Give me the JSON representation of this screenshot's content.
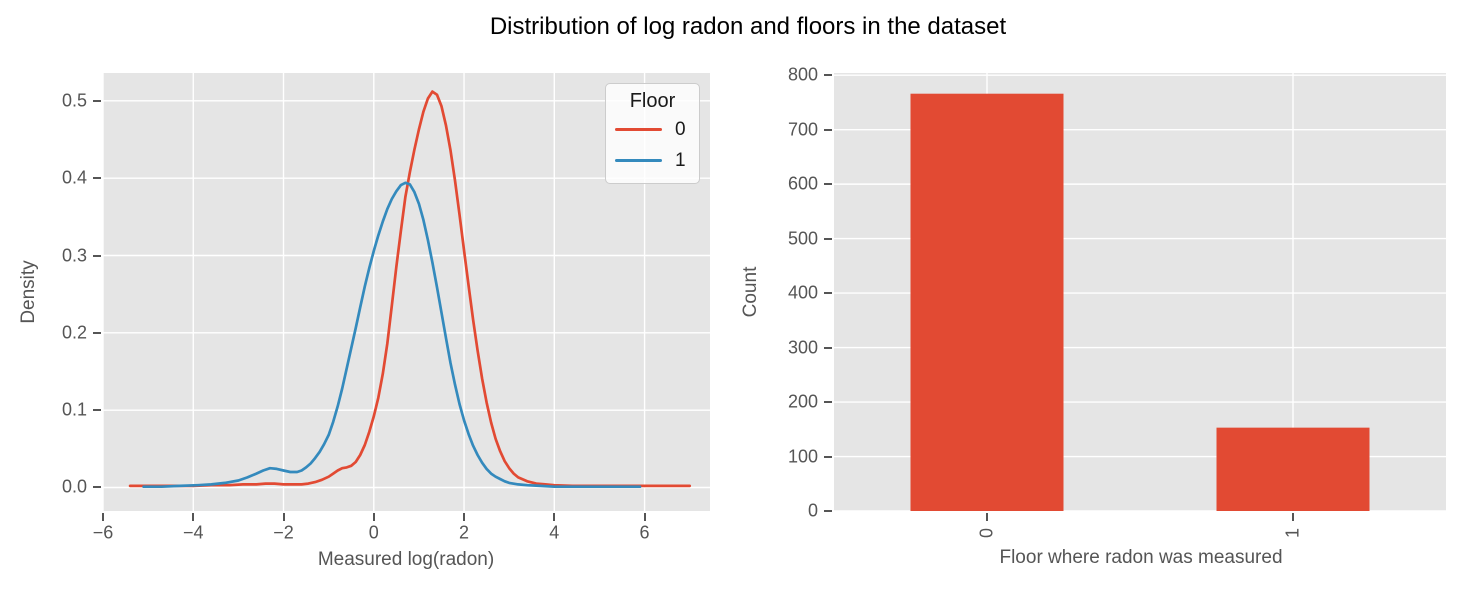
{
  "title": "Distribution of log radon and floors in the dataset",
  "colors": {
    "floor0_red": "#E24A33",
    "floor1_blue": "#348ABD",
    "axes_background": "#E5E5E5",
    "grid": "#FFFFFF",
    "tick_text": "#555555",
    "title_text": "#000000"
  },
  "chart_data": [
    {
      "type": "line",
      "subtype": "kde-density",
      "xlabel": "Measured log(radon)",
      "ylabel": "Density",
      "xlim": [
        -6.0,
        7.45
      ],
      "ylim": [
        -0.0304,
        0.536
      ],
      "grid": true,
      "xticks": [
        -6,
        -4,
        -2,
        0,
        2,
        4,
        6
      ],
      "xtick_labels": [
        "−6",
        "−4",
        "−2",
        "0",
        "2",
        "4",
        "6"
      ],
      "yticks": [
        0,
        0.1,
        0.2,
        0.3,
        0.4,
        0.5
      ],
      "ytick_labels": [
        "0.0",
        "0.1",
        "0.2",
        "0.3",
        "0.4",
        "0.5"
      ],
      "legend": {
        "title": "Floor",
        "position": "upper right",
        "entries": [
          {
            "label": "0",
            "color": "#E24A33"
          },
          {
            "label": "1",
            "color": "#348ABD"
          }
        ]
      },
      "series": [
        {
          "name": "0",
          "color": "#E24A33",
          "points": [
            [
              -5.4,
              0.002
            ],
            [
              -5.0,
              0.002
            ],
            [
              -4.5,
              0.002
            ],
            [
              -4.0,
              0.002
            ],
            [
              -3.6,
              0.003
            ],
            [
              -3.2,
              0.003
            ],
            [
              -2.9,
              0.004
            ],
            [
              -2.6,
              0.004
            ],
            [
              -2.4,
              0.005
            ],
            [
              -2.2,
              0.005
            ],
            [
              -2.0,
              0.004
            ],
            [
              -1.8,
              0.004
            ],
            [
              -1.6,
              0.004
            ],
            [
              -1.45,
              0.005
            ],
            [
              -1.3,
              0.007
            ],
            [
              -1.15,
              0.01
            ],
            [
              -1.0,
              0.014
            ],
            [
              -0.9,
              0.018
            ],
            [
              -0.8,
              0.022
            ],
            [
              -0.7,
              0.025
            ],
            [
              -0.6,
              0.026
            ],
            [
              -0.5,
              0.028
            ],
            [
              -0.4,
              0.033
            ],
            [
              -0.3,
              0.042
            ],
            [
              -0.2,
              0.055
            ],
            [
              -0.1,
              0.072
            ],
            [
              0.0,
              0.092
            ],
            [
              0.1,
              0.116
            ],
            [
              0.2,
              0.147
            ],
            [
              0.3,
              0.186
            ],
            [
              0.4,
              0.235
            ],
            [
              0.5,
              0.285
            ],
            [
              0.6,
              0.332
            ],
            [
              0.7,
              0.376
            ],
            [
              0.8,
              0.408
            ],
            [
              0.9,
              0.437
            ],
            [
              1.0,
              0.463
            ],
            [
              1.1,
              0.486
            ],
            [
              1.2,
              0.503
            ],
            [
              1.3,
              0.512
            ],
            [
              1.4,
              0.508
            ],
            [
              1.5,
              0.493
            ],
            [
              1.6,
              0.468
            ],
            [
              1.7,
              0.436
            ],
            [
              1.8,
              0.397
            ],
            [
              1.9,
              0.353
            ],
            [
              2.0,
              0.307
            ],
            [
              2.1,
              0.261
            ],
            [
              2.2,
              0.217
            ],
            [
              2.3,
              0.177
            ],
            [
              2.4,
              0.141
            ],
            [
              2.5,
              0.11
            ],
            [
              2.6,
              0.084
            ],
            [
              2.7,
              0.063
            ],
            [
              2.8,
              0.047
            ],
            [
              2.9,
              0.034
            ],
            [
              3.0,
              0.025
            ],
            [
              3.1,
              0.018
            ],
            [
              3.2,
              0.013
            ],
            [
              3.4,
              0.008
            ],
            [
              3.6,
              0.005
            ],
            [
              3.8,
              0.004
            ],
            [
              4.0,
              0.003
            ],
            [
              4.4,
              0.002
            ],
            [
              5.0,
              0.002
            ],
            [
              5.6,
              0.002
            ],
            [
              6.2,
              0.002
            ],
            [
              6.6,
              0.002
            ],
            [
              7.0,
              0.002
            ]
          ]
        },
        {
          "name": "1",
          "color": "#348ABD",
          "points": [
            [
              -5.1,
              0.001
            ],
            [
              -4.7,
              0.001
            ],
            [
              -4.3,
              0.002
            ],
            [
              -3.9,
              0.003
            ],
            [
              -3.6,
              0.004
            ],
            [
              -3.3,
              0.006
            ],
            [
              -3.0,
              0.009
            ],
            [
              -2.8,
              0.013
            ],
            [
              -2.6,
              0.018
            ],
            [
              -2.45,
              0.022
            ],
            [
              -2.3,
              0.025
            ],
            [
              -2.15,
              0.024
            ],
            [
              -2.0,
              0.022
            ],
            [
              -1.85,
              0.02
            ],
            [
              -1.7,
              0.02
            ],
            [
              -1.6,
              0.022
            ],
            [
              -1.5,
              0.026
            ],
            [
              -1.4,
              0.031
            ],
            [
              -1.3,
              0.038
            ],
            [
              -1.2,
              0.046
            ],
            [
              -1.1,
              0.056
            ],
            [
              -1.0,
              0.068
            ],
            [
              -0.9,
              0.085
            ],
            [
              -0.8,
              0.105
            ],
            [
              -0.7,
              0.128
            ],
            [
              -0.6,
              0.154
            ],
            [
              -0.5,
              0.18
            ],
            [
              -0.4,
              0.206
            ],
            [
              -0.3,
              0.233
            ],
            [
              -0.2,
              0.26
            ],
            [
              -0.1,
              0.284
            ],
            [
              0.0,
              0.306
            ],
            [
              0.1,
              0.326
            ],
            [
              0.2,
              0.344
            ],
            [
              0.3,
              0.36
            ],
            [
              0.4,
              0.373
            ],
            [
              0.5,
              0.383
            ],
            [
              0.6,
              0.391
            ],
            [
              0.7,
              0.394
            ],
            [
              0.8,
              0.392
            ],
            [
              0.9,
              0.382
            ],
            [
              1.0,
              0.367
            ],
            [
              1.1,
              0.346
            ],
            [
              1.2,
              0.32
            ],
            [
              1.3,
              0.291
            ],
            [
              1.4,
              0.259
            ],
            [
              1.5,
              0.226
            ],
            [
              1.6,
              0.193
            ],
            [
              1.7,
              0.161
            ],
            [
              1.8,
              0.133
            ],
            [
              1.9,
              0.108
            ],
            [
              2.0,
              0.087
            ],
            [
              2.1,
              0.069
            ],
            [
              2.2,
              0.054
            ],
            [
              2.3,
              0.042
            ],
            [
              2.4,
              0.032
            ],
            [
              2.5,
              0.024
            ],
            [
              2.6,
              0.018
            ],
            [
              2.7,
              0.014
            ],
            [
              2.8,
              0.011
            ],
            [
              2.9,
              0.008
            ],
            [
              3.0,
              0.006
            ],
            [
              3.2,
              0.004
            ],
            [
              3.4,
              0.003
            ],
            [
              3.7,
              0.002
            ],
            [
              4.0,
              0.001
            ],
            [
              4.5,
              0.001
            ],
            [
              5.0,
              0.001
            ],
            [
              5.5,
              0.001
            ],
            [
              5.9,
              0.001
            ]
          ]
        }
      ]
    },
    {
      "type": "bar",
      "xlabel": "Floor where radon was measured",
      "ylabel": "Count",
      "categories": [
        "0",
        "1"
      ],
      "values": [
        766,
        153
      ],
      "bar_color": "#E24A33",
      "bar_width": 0.5,
      "xlim": [
        -0.5,
        1.5
      ],
      "ylim": [
        0,
        804
      ],
      "grid": true,
      "yticks": [
        0,
        100,
        200,
        300,
        400,
        500,
        600,
        700,
        800
      ],
      "ytick_labels": [
        "0",
        "100",
        "200",
        "300",
        "400",
        "500",
        "600",
        "700",
        "800"
      ],
      "xtick_labels": [
        "0",
        "1"
      ],
      "xtick_rotation": 90
    }
  ]
}
